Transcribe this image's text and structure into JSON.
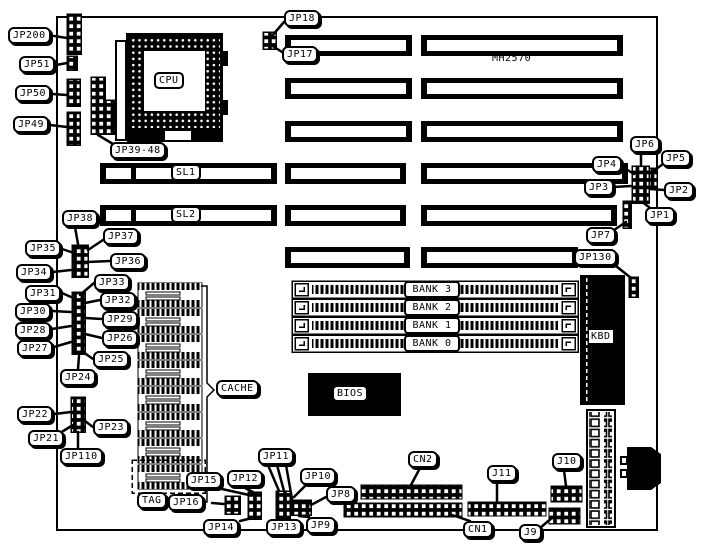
{
  "diagram": {
    "model_text": "MH2570",
    "ink_color": "#000000",
    "paper_color": "#ffffff"
  },
  "labels": [
    {
      "id": "jp200",
      "text": "JP200",
      "x": 8,
      "y": 27,
      "leaders": [
        [
          54,
          36,
          67,
          38
        ]
      ]
    },
    {
      "id": "jp51",
      "text": "JP51",
      "x": 19,
      "y": 56,
      "leaders": [
        [
          56,
          65,
          67,
          63
        ]
      ]
    },
    {
      "id": "jp50",
      "text": "JP50",
      "x": 15,
      "y": 85,
      "leaders": [
        [
          52,
          94,
          67,
          95
        ]
      ]
    },
    {
      "id": "jp49",
      "text": "JP49",
      "x": 13,
      "y": 116,
      "leaders": [
        [
          50,
          125,
          67,
          127
        ]
      ]
    },
    {
      "id": "jp18",
      "text": "JP18",
      "x": 284,
      "y": 10,
      "leaders": [
        [
          284,
          22,
          271,
          37
        ]
      ]
    },
    {
      "id": "jp17",
      "text": "JP17",
      "x": 282,
      "y": 46,
      "leaders": [
        [
          282,
          52,
          271,
          45
        ]
      ]
    },
    {
      "id": "jp39-48",
      "text": "JP39-48",
      "x": 110,
      "y": 142,
      "leaders": [
        [
          113,
          144,
          98,
          135
        ]
      ]
    },
    {
      "id": "mh2570",
      "text": "MH2570",
      "x": 492,
      "y": 52,
      "style": "plain"
    },
    {
      "id": "cpu",
      "text": "CPU",
      "x": 154,
      "y": 72,
      "style": "box"
    },
    {
      "id": "amp",
      "text": "AMP",
      "x": 192,
      "y": 128,
      "style": "inverse"
    },
    {
      "id": "sl1",
      "text": "SL1",
      "x": 171,
      "y": 164,
      "style": "box"
    },
    {
      "id": "sl2",
      "text": "SL2",
      "x": 171,
      "y": 206,
      "style": "box"
    },
    {
      "id": "jp6",
      "text": "JP6",
      "x": 630,
      "y": 136,
      "leaders": [
        [
          641,
          153,
          641,
          166
        ]
      ]
    },
    {
      "id": "jp5",
      "text": "JP5",
      "x": 661,
      "y": 150,
      "leaders": [
        [
          663,
          164,
          652,
          172
        ]
      ]
    },
    {
      "id": "jp4",
      "text": "JP4",
      "x": 592,
      "y": 156,
      "leaders": [
        [
          626,
          169,
          634,
          174
        ]
      ]
    },
    {
      "id": "jp3",
      "text": "JP3",
      "x": 584,
      "y": 179,
      "leaders": [
        [
          614,
          187,
          631,
          186
        ]
      ]
    },
    {
      "id": "jp2",
      "text": "JP2",
      "x": 664,
      "y": 182,
      "leaders": [
        [
          664,
          190,
          650,
          189
        ]
      ]
    },
    {
      "id": "jp1",
      "text": "JP1",
      "x": 645,
      "y": 207,
      "leaders": [
        [
          649,
          207,
          642,
          202
        ]
      ]
    },
    {
      "id": "jp7",
      "text": "JP7",
      "x": 586,
      "y": 227,
      "leaders": [
        [
          614,
          230,
          626,
          222
        ]
      ]
    },
    {
      "id": "jp130",
      "text": "JP130",
      "x": 574,
      "y": 249,
      "leaders": [
        [
          616,
          266,
          631,
          278
        ]
      ]
    },
    {
      "id": "jp38",
      "text": "JP38",
      "x": 62,
      "y": 210,
      "leaders": [
        [
          75,
          227,
          78,
          244
        ]
      ]
    },
    {
      "id": "jp37",
      "text": "JP37",
      "x": 103,
      "y": 228,
      "leaders": [
        [
          103,
          240,
          88,
          250
        ]
      ]
    },
    {
      "id": "jp35",
      "text": "JP35",
      "x": 25,
      "y": 240,
      "leaders": [
        [
          62,
          249,
          71,
          252
        ]
      ]
    },
    {
      "id": "jp36",
      "text": "JP36",
      "x": 110,
      "y": 253,
      "leaders": [
        [
          110,
          261,
          88,
          262
        ]
      ]
    },
    {
      "id": "jp34",
      "text": "JP34",
      "x": 16,
      "y": 264,
      "leaders": [
        [
          53,
          272,
          71,
          270
        ]
      ]
    },
    {
      "id": "jp33",
      "text": "JP33",
      "x": 94,
      "y": 274,
      "leaders": [
        [
          94,
          283,
          80,
          295
        ]
      ]
    },
    {
      "id": "jp31",
      "text": "JP31",
      "x": 25,
      "y": 285,
      "leaders": [
        [
          62,
          293,
          71,
          297
        ]
      ]
    },
    {
      "id": "jp32",
      "text": "JP32",
      "x": 100,
      "y": 292,
      "leaders": [
        [
          100,
          300,
          85,
          303
        ]
      ]
    },
    {
      "id": "jp30",
      "text": "JP30",
      "x": 15,
      "y": 303,
      "leaders": [
        [
          52,
          311,
          71,
          312
        ]
      ]
    },
    {
      "id": "jp29",
      "text": "JP29",
      "x": 102,
      "y": 311,
      "leaders": [
        [
          102,
          319,
          85,
          318
        ]
      ]
    },
    {
      "id": "jp28",
      "text": "JP28",
      "x": 15,
      "y": 322,
      "leaders": [
        [
          52,
          329,
          71,
          326
        ]
      ]
    },
    {
      "id": "jp26",
      "text": "JP26",
      "x": 102,
      "y": 330,
      "leaders": [
        [
          102,
          338,
          85,
          334
        ]
      ]
    },
    {
      "id": "jp27",
      "text": "JP27",
      "x": 17,
      "y": 340,
      "leaders": [
        [
          54,
          347,
          71,
          342
        ]
      ]
    },
    {
      "id": "jp25",
      "text": "JP25",
      "x": 93,
      "y": 351,
      "leaders": [
        [
          93,
          359,
          83,
          352
        ]
      ]
    },
    {
      "id": "jp24",
      "text": "JP24",
      "x": 60,
      "y": 369,
      "leaders": [
        [
          78,
          369,
          79,
          356
        ]
      ]
    },
    {
      "id": "jp22",
      "text": "JP22",
      "x": 17,
      "y": 406,
      "leaders": [
        [
          54,
          414,
          71,
          412
        ]
      ]
    },
    {
      "id": "jp21",
      "text": "JP21",
      "x": 28,
      "y": 430,
      "leaders": [
        [
          60,
          433,
          73,
          425
        ]
      ]
    },
    {
      "id": "jp23",
      "text": "JP23",
      "x": 93,
      "y": 419,
      "leaders": [
        [
          93,
          427,
          85,
          421
        ]
      ]
    },
    {
      "id": "jp110",
      "text": "JP110",
      "x": 60,
      "y": 448,
      "leaders": [
        [
          78,
          448,
          78,
          432
        ]
      ]
    },
    {
      "id": "cache",
      "text": "CACHE",
      "x": 216,
      "y": 380
    },
    {
      "id": "bios",
      "text": "BIOS",
      "x": 332,
      "y": 385,
      "style": "box"
    },
    {
      "id": "kbd",
      "text": "KBD",
      "x": 589,
      "y": 330,
      "style": "chip"
    },
    {
      "id": "tag",
      "text": "TAG",
      "x": 137,
      "y": 492
    },
    {
      "id": "jp15",
      "text": "JP15",
      "x": 186,
      "y": 472,
      "leaders": [
        [
          222,
          489,
          249,
          495
        ]
      ]
    },
    {
      "id": "jp16",
      "text": "JP16",
      "x": 168,
      "y": 494,
      "leaders": [
        [
          212,
          503,
          224,
          504
        ]
      ]
    },
    {
      "id": "jp12",
      "text": "JP12",
      "x": 227,
      "y": 470,
      "leaders": [
        [
          243,
          487,
          253,
          492
        ]
      ]
    },
    {
      "id": "jp11",
      "text": "JP11",
      "x": 258,
      "y": 448,
      "leaders": [
        [
          268,
          465,
          279,
          491
        ],
        [
          277,
          465,
          284,
          491
        ],
        [
          286,
          465,
          292,
          499
        ]
      ]
    },
    {
      "id": "jp10",
      "text": "JP10",
      "x": 300,
      "y": 468,
      "leaders": [
        [
          306,
          485,
          294,
          497
        ]
      ]
    },
    {
      "id": "jp8",
      "text": "JP8",
      "x": 326,
      "y": 486,
      "leaders": [
        [
          326,
          497,
          311,
          505
        ]
      ]
    },
    {
      "id": "jp14",
      "text": "JP14",
      "x": 203,
      "y": 519,
      "leaders": [
        [
          240,
          521,
          252,
          518
        ]
      ]
    },
    {
      "id": "jp13",
      "text": "JP13",
      "x": 266,
      "y": 519,
      "leaders": [
        [
          282,
          520,
          284,
          519
        ]
      ]
    },
    {
      "id": "jp9",
      "text": "JP9",
      "x": 306,
      "y": 517,
      "leaders": [
        [
          309,
          517,
          299,
          516
        ]
      ]
    },
    {
      "id": "cn2",
      "text": "CN2",
      "x": 408,
      "y": 451,
      "leaders": [
        [
          420,
          468,
          411,
          485
        ]
      ]
    },
    {
      "id": "cn1",
      "text": "CN1",
      "x": 463,
      "y": 521,
      "leaders": [
        [
          470,
          521,
          452,
          515
        ]
      ]
    },
    {
      "id": "j11",
      "text": "J11",
      "x": 487,
      "y": 465,
      "leaders": [
        [
          497,
          482,
          497,
          501
        ]
      ]
    },
    {
      "id": "j10",
      "text": "J10",
      "x": 552,
      "y": 453,
      "leaders": [
        [
          564,
          470,
          566,
          486
        ]
      ]
    },
    {
      "id": "j9",
      "text": "J9",
      "x": 519,
      "y": 524,
      "leaders": [
        [
          540,
          528,
          553,
          517
        ]
      ]
    },
    {
      "id": "bank3",
      "text": "BANK 3",
      "x": 404,
      "y": 281,
      "style": "bank"
    },
    {
      "id": "bank2",
      "text": "BANK 2",
      "x": 404,
      "y": 299,
      "style": "bank"
    },
    {
      "id": "bank1",
      "text": "BANK 1",
      "x": 404,
      "y": 317,
      "style": "bank"
    },
    {
      "id": "bank0",
      "text": "BANK 0",
      "x": 404,
      "y": 335,
      "style": "bank"
    }
  ]
}
